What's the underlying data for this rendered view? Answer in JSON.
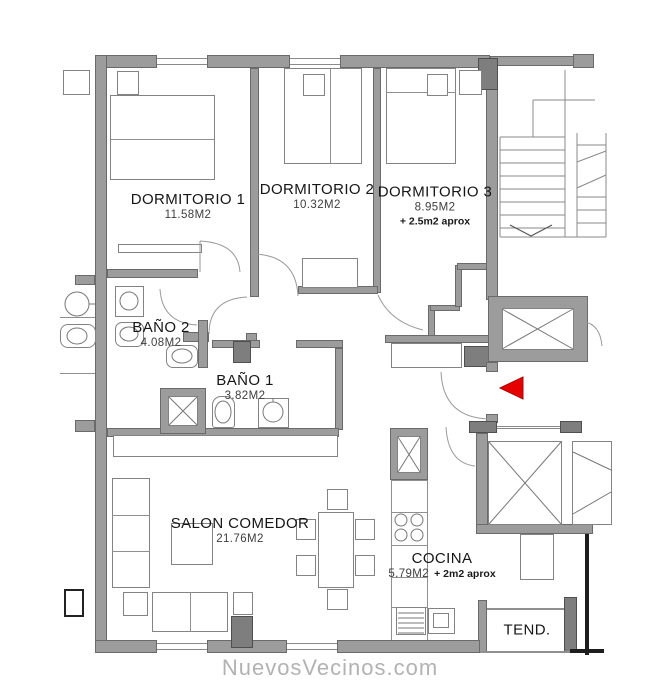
{
  "rooms": [
    {
      "id": "dormitorio-1",
      "name": "DORMITORIO 1",
      "area": "11.58M2",
      "extra": ""
    },
    {
      "id": "dormitorio-2",
      "name": "DORMITORIO 2",
      "area": "10.32M2",
      "extra": ""
    },
    {
      "id": "dormitorio-3",
      "name": "DORMITORIO 3",
      "area": "8.95M2",
      "extra": "+ 2.5m2 aprox"
    },
    {
      "id": "bano-2",
      "name": "BAÑO 2",
      "area": "4.08M2",
      "extra": ""
    },
    {
      "id": "bano-1",
      "name": "BAÑO 1",
      "area": "3.82M2",
      "extra": ""
    },
    {
      "id": "salon-comedor",
      "name": "SALON COMEDOR",
      "area": "21.76M2",
      "extra": ""
    },
    {
      "id": "cocina",
      "name": "COCINA",
      "area": "5.79M2",
      "extra": "+ 2m2 aprox"
    },
    {
      "id": "tendedero",
      "name": "TEND.",
      "area": "",
      "extra": ""
    }
  ],
  "watermark": {
    "text": "NuevosVecinos.com"
  },
  "colors": {
    "wall": "#9c9c9c",
    "wall_dark": "#7e7e7e",
    "line": "#8f8f8f",
    "entrance_arrow": "#e60000",
    "text": "#161616",
    "watermark": "#b2b2b2"
  }
}
